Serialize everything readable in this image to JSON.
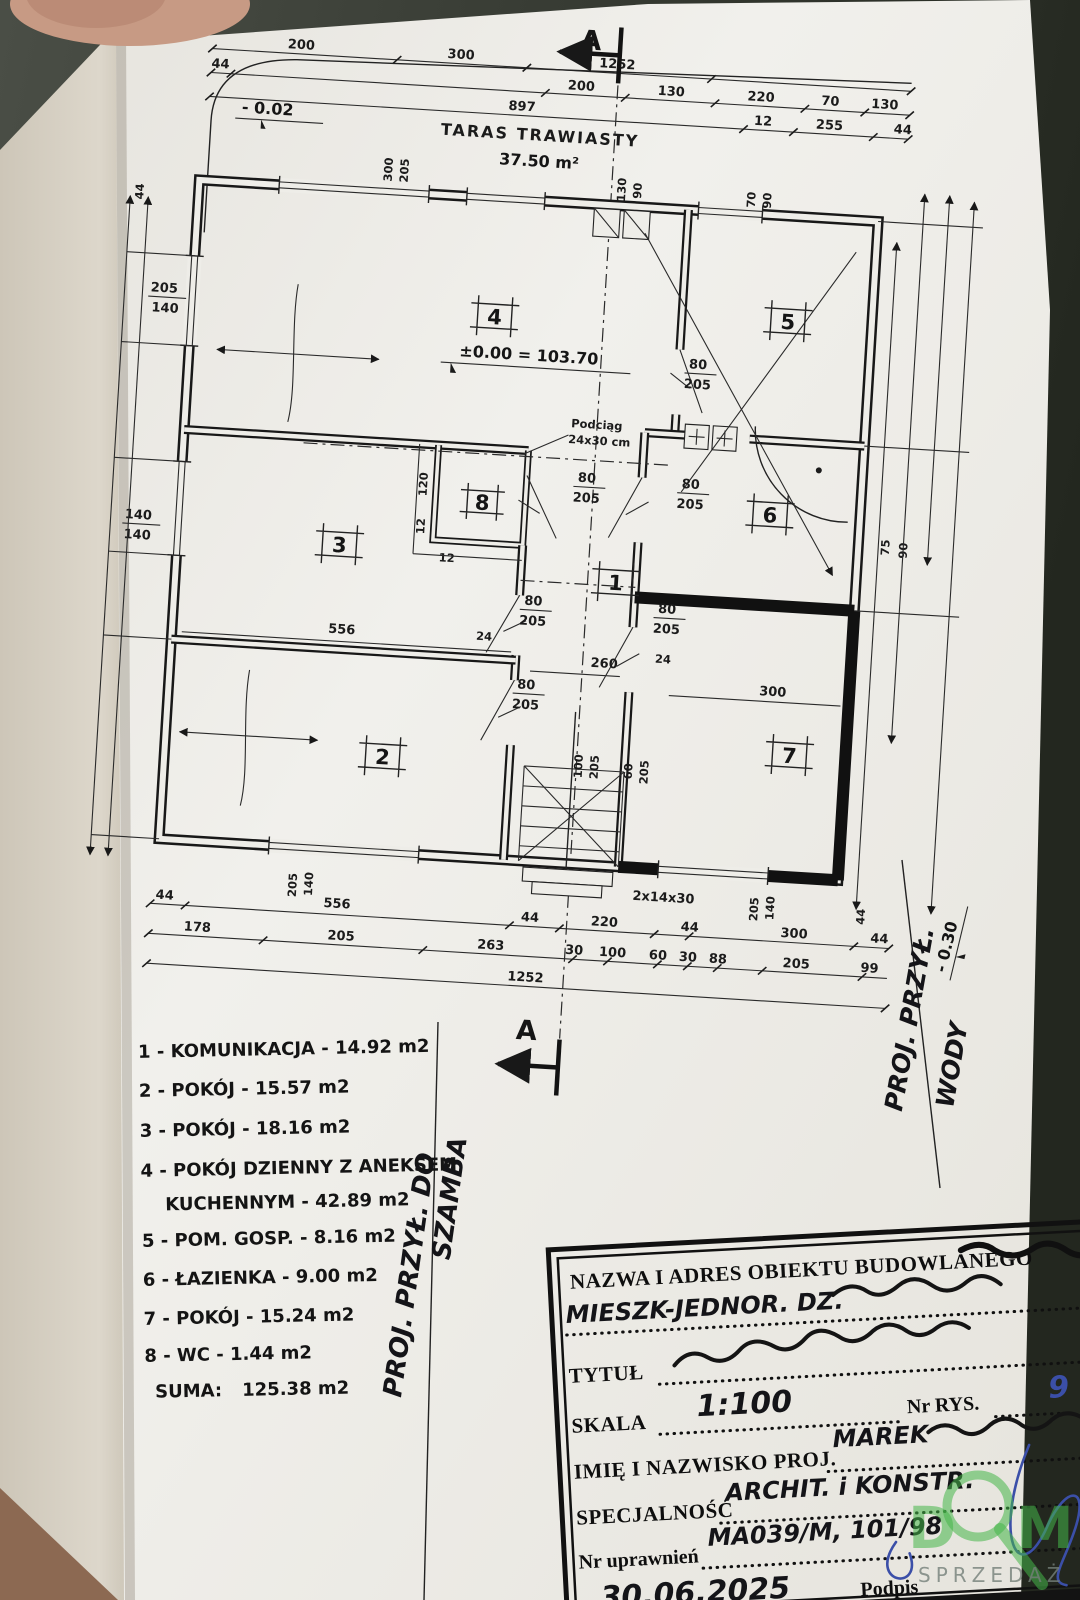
{
  "colors": {
    "paper": "#efeee9",
    "ink": "#1b1b1b",
    "table": "#8c6952",
    "background": "#3c4039",
    "pen_blue": "#3b4fa8",
    "watermark_green": "#45b649"
  },
  "plan": {
    "section": "A",
    "terrace": {
      "name": "TARAS TRAWIASTY",
      "area": "37.50 m²"
    },
    "levels": {
      "entry": "- 0.02",
      "zero": "±0.00 = 103.70",
      "edge": "- 0.30"
    },
    "beam": {
      "l1": "Podciąg",
      "l2": "24x30 cm"
    },
    "stairs": "2x14x30",
    "rooms": [
      "1",
      "2",
      "3",
      "4",
      "5",
      "6",
      "7",
      "8"
    ],
    "topDims": [
      "200",
      "300",
      "1252",
      "44",
      "200",
      "130",
      "220",
      "70",
      "130",
      "897",
      "12",
      "255",
      "44"
    ],
    "botR1": [
      "44",
      "556",
      "44",
      "220",
      "44",
      "300",
      "44"
    ],
    "botR2": [
      "178",
      "205",
      "263",
      "30",
      "100",
      "60",
      "30",
      "88",
      "205",
      "99"
    ],
    "botTotal": "1252",
    "door_std": {
      "w": "80",
      "h": "205"
    },
    "door_main": {
      "w": "100",
      "h": "205"
    },
    "door_small": {
      "w": "60",
      "h": "205"
    },
    "win_a": {
      "w": "205",
      "h": "140"
    },
    "win_b": {
      "w": "140",
      "h": "140"
    },
    "win_c": {
      "w": "300",
      "h": "205"
    },
    "vent": {
      "w": "130",
      "h": "90"
    },
    "win_d": {
      "w": "70",
      "h": "90"
    },
    "inner": {
      "d120": "120",
      "d12": "12",
      "w556": "556",
      "t24": "24",
      "w260": "260",
      "w300": "300",
      "r75": "75",
      "r90": "90",
      "s44": "44"
    }
  },
  "notes": {
    "left1": "PROJ. PRZYŁ. DO",
    "left2": "SZAMBA",
    "right1": "PROJ. PRZYŁ.",
    "right2": "WODY"
  },
  "legend": {
    "items": [
      "1 - KOMUNIKACJA - 14.92 m2",
      "2 - POKÓJ - 15.57 m2",
      "3 - POKÓJ - 18.16 m2",
      "4 - POKÓJ DZIENNY Z ANEKSEM",
      "KUCHENNYM - 42.89 m2",
      "5 - POM. GOSP. - 8.16 m2",
      "6 - ŁAZIENKA - 9.00 m2",
      "7 - POKÓJ - 15.24 m2",
      "8 - WC - 1.44 m2"
    ],
    "suma_label": "SUMA:",
    "suma_value": "125.38 m2"
  },
  "stamp": {
    "header": "NAZWA I ADRES OBIEKTU BUDOWLANEGO",
    "obj_hw": "MIESZK-JEDNOR. DZ.",
    "tytul": "TYTUŁ",
    "skala": "SKALA",
    "skala_hw": "1:100",
    "nr_rys": "Nr RYS.",
    "nr_rys_hw": "9",
    "imie": "IMIĘ I NAZWISKO PROJ.",
    "imie_hw": "MAREK",
    "spec": "SPECJALNOŚĆ",
    "spec_hw": "ARCHIT. i KONSTR.",
    "nr_upr": "Nr uprawnień",
    "nr_upr_hw": "MA039/M, 101/98",
    "date_hw": "30.06.2025",
    "podpis": "Podpis"
  },
  "watermark": {
    "d": "D",
    "m": "M",
    "sub": "SPRZEDAŻ"
  }
}
